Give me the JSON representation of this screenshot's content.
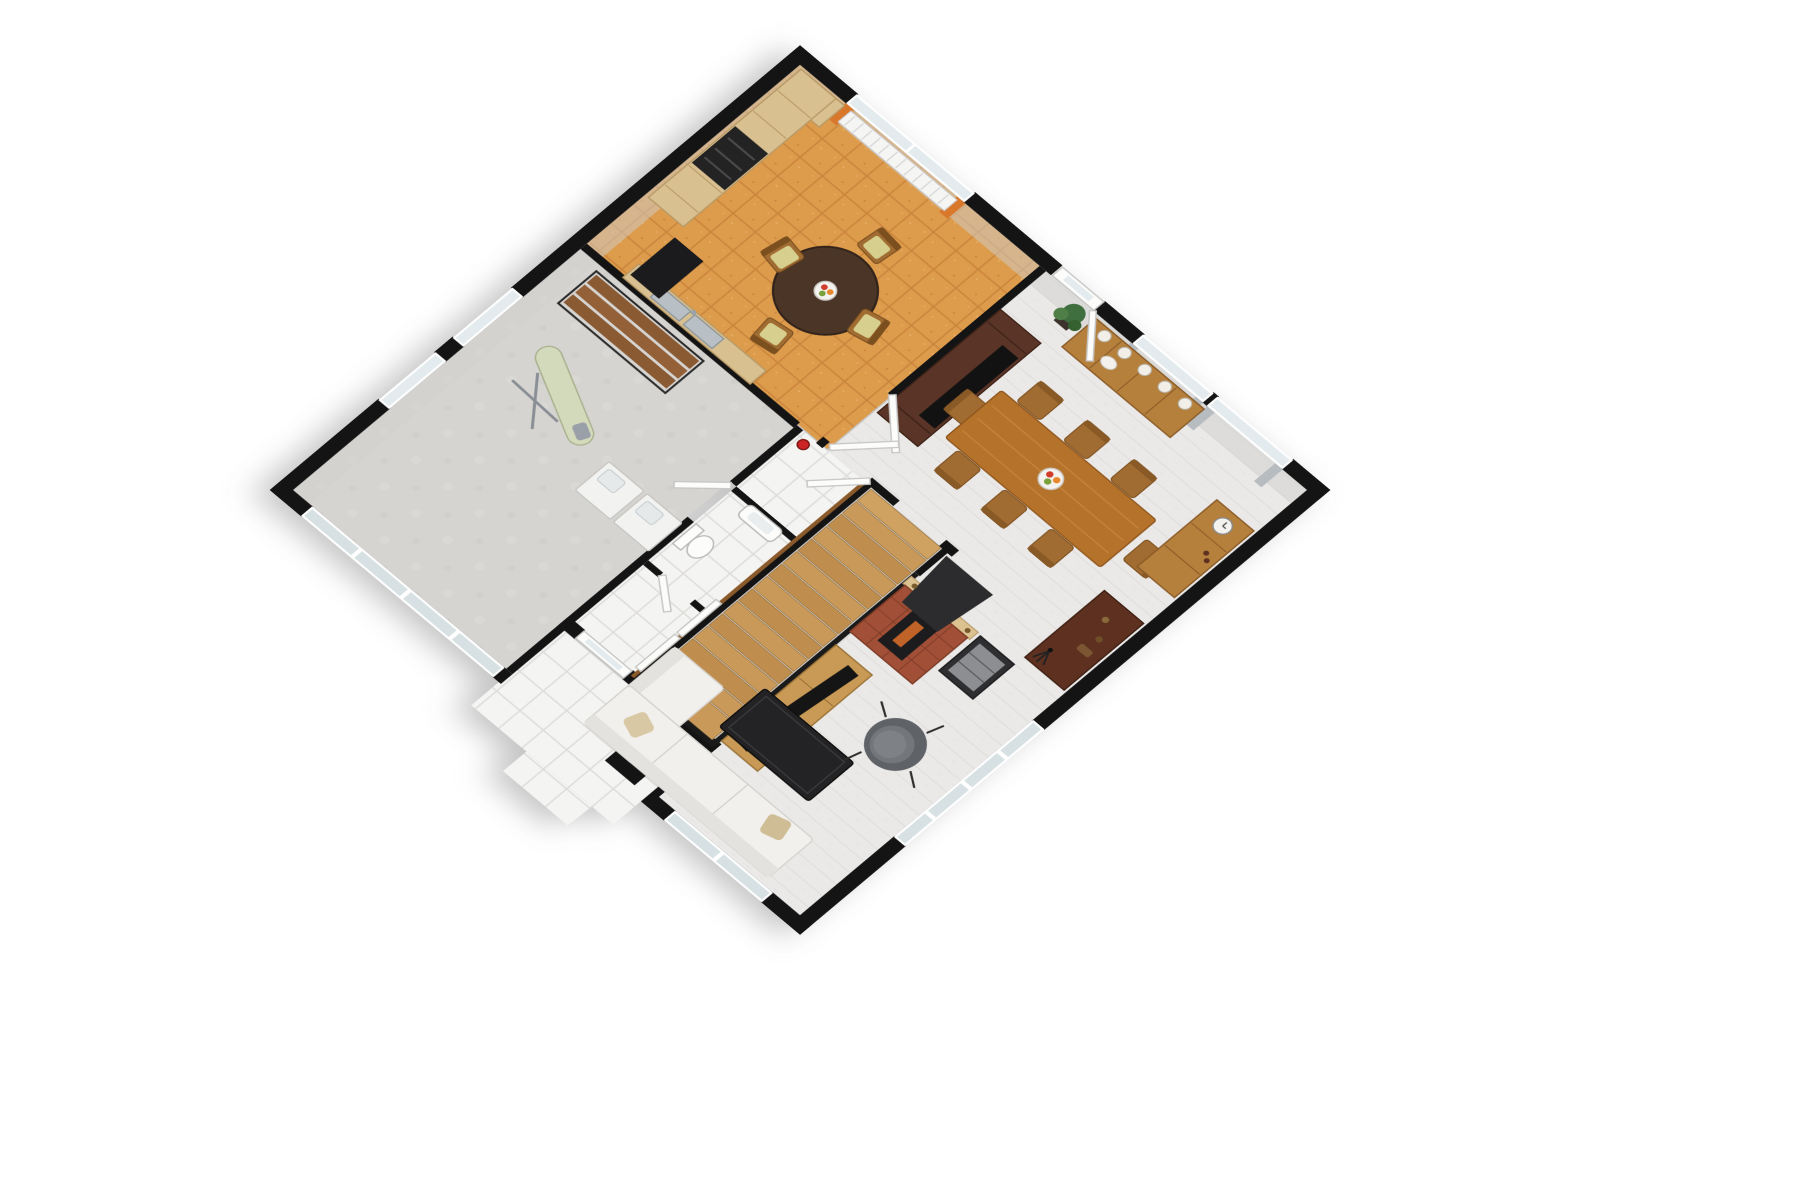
{
  "scene": {
    "type": "3d-floorplan-cutaway-render",
    "floor_label": "ground floor",
    "background": "#ffffff",
    "projection": {
      "plan_rotation_deg": 45,
      "tilt_deg": 33
    }
  },
  "palette": {
    "wall": "#141414",
    "wallFace": "#cfcfce",
    "kitchenTile": "#dd9b4c",
    "kitchenGrout": "#c9833b",
    "livingFloor": "#eae9e7",
    "livingLine": "#dfdedb",
    "utilityFloor": "#d6d4d1",
    "tileWhite": "#f4f4f2",
    "tileGrout": "#dcdbd8",
    "stairBase": "#d9d8d6",
    "tread": "#c9995a",
    "treadAlt": "#bf8e4e",
    "treadEdge": "#96713d",
    "handrail": "#8a5a2b",
    "railBlack": "#1a1a1a",
    "woodLight": "#d9c091",
    "woodLightEdge": "#b89a66",
    "woodMid": "#b5722a",
    "woodMidEdge": "#8f561c",
    "woodCab": "#b5803c",
    "woodCabEdge": "#8a5a26",
    "woodDark": "#5a3426",
    "woodDarkEdge": "#3f2318",
    "woodDesk": "#5d3020",
    "woodShelf": "#8a5a33",
    "lowboard": "#c89a55",
    "brick": "#a14f36",
    "mantel": "#dcc191",
    "hood": "#2c2c2e",
    "hifiBody": "#2f2f31",
    "hifiFront": "#8c8e92",
    "tvBlack": "#151515",
    "applianceBlack": "#232323",
    "speakerBlack": "#1b1b1d",
    "tableBlack": "#232325",
    "chairGray": "#5f6267",
    "chairGrayIn": "#74777a",
    "sofaWhite": "#f1f0ed",
    "sofaShade": "#e4e2de",
    "sofaLine": "#d5d3cf",
    "pillowBeige": "#d9c8a4",
    "chairWood": "#a06c32",
    "chairWoodEdge": "#7c4f1f",
    "chairSeat": "#d6cf8e",
    "espresso": "#4a3526",
    "steel": "#b9c0c5",
    "steelEdge": "#8f979c",
    "glass": "#e3ebee",
    "glassDark": "#d7e1e4",
    "frameWhite": "#fbfbfb",
    "doorWhite": "#fcfcfb",
    "doorEdge": "#c6c6c4",
    "curtainOrange": "#d9772b",
    "curtainGray": "#b6bcc0",
    "plantGreen": "#3f6f3f",
    "plantGreenLt": "#4f7f47",
    "potDark": "#3c342c",
    "extinguisherRed": "#cc2424",
    "applianceWhite": "#f2f2f0",
    "boardGreen": "#d3d9bb",
    "boardEdge": "#aab28f",
    "ironGray": "#9aa0a8",
    "radiatorWhite": "#f5f5f4",
    "plateWhite": "#f2efe9",
    "fruitRed": "#d23c2a",
    "fruitOrange": "#e8872c",
    "fruitGreen": "#7aa03c",
    "bowlWhite": "#f4f2ee"
  },
  "rooms": [
    {
      "id": "kitchen-dining",
      "label": "Kitchen / breakfast",
      "floor": "orange speckled tile"
    },
    {
      "id": "living-room",
      "label": "Living / dining room",
      "floor": "light plank tile"
    },
    {
      "id": "utility-room",
      "label": "Utility / laundry room",
      "floor": "gray concrete"
    },
    {
      "id": "hallway",
      "label": "Hallway / entry",
      "floor": "white tile"
    },
    {
      "id": "wc",
      "label": "WC",
      "floor": "white tile"
    },
    {
      "id": "staircase",
      "label": "Staircase",
      "floor": "wood treads"
    },
    {
      "id": "porch",
      "label": "Entry porch / terrace",
      "floor": "white tile grid"
    }
  ],
  "furniture": [
    {
      "id": "kitchen-cabinets",
      "room": "kitchen-dining",
      "label": "Light wood cabinet run with built-in oven and microwave"
    },
    {
      "id": "kitchen-counter-sink",
      "room": "kitchen-dining",
      "label": "Counter with double stainless sink"
    },
    {
      "id": "radiator",
      "room": "kitchen-dining",
      "label": "Radiator under window"
    },
    {
      "id": "kitchen-round-table",
      "room": "kitchen-dining",
      "label": "Round espresso table with 4 chairs and fruit bowl"
    },
    {
      "id": "tall-speaker",
      "room": "kitchen-dining",
      "label": "Black speaker cabinet"
    },
    {
      "id": "fire-extinguisher",
      "room": "hallway",
      "label": "Red fire extinguisher"
    },
    {
      "id": "open-shelf-unit",
      "room": "utility-room",
      "label": "Metal frame wood shelf unit"
    },
    {
      "id": "ironing-board",
      "room": "utility-room",
      "label": "Ironing board with iron"
    },
    {
      "id": "laundry-units",
      "room": "utility-room",
      "label": "Two white laundry units"
    },
    {
      "id": "wc-sink",
      "room": "wc",
      "label": "Wall hung sink"
    },
    {
      "id": "toilet",
      "room": "wc",
      "label": "Toilet"
    },
    {
      "id": "staircase-wood",
      "room": "staircase",
      "label": "Wood staircase with black railing"
    },
    {
      "id": "tv-hutch",
      "room": "living-room",
      "label": "Dark walnut media hutch"
    },
    {
      "id": "sideboard",
      "room": "living-room",
      "label": "Sideboard with decorative plates and teapot"
    },
    {
      "id": "potted-plant",
      "room": "living-room",
      "label": "Potted plant"
    },
    {
      "id": "dining-table",
      "room": "living-room",
      "label": "Dining table with 8 chairs and fruit bowl"
    },
    {
      "id": "display-cabinet",
      "room": "living-room",
      "label": "Cabinet with clock and bottles"
    },
    {
      "id": "writing-desk",
      "room": "living-room",
      "label": "Dark wood desk with figurines and camera tripod"
    },
    {
      "id": "fireplace",
      "room": "living-room",
      "label": "Brick fireplace with black chimney hood and candlesticks"
    },
    {
      "id": "hifi-cabinet",
      "room": "living-room",
      "label": "Black hi-fi cabinet"
    },
    {
      "id": "tv-lowboard",
      "room": "living-room",
      "label": "Oak lowboard with flat TV"
    },
    {
      "id": "coffee-table",
      "room": "living-room",
      "label": "Black coffee table"
    },
    {
      "id": "armchair",
      "room": "living-room",
      "label": "Gray tub armchair"
    },
    {
      "id": "corner-sofa",
      "room": "living-room",
      "label": "White corner sofa with beige cushions"
    },
    {
      "id": "glass-balustrade",
      "room": "living-room",
      "label": "Glass partition panels"
    },
    {
      "id": "sliding-glass-doors",
      "room": "utility-room",
      "label": "Glazed sliding wall"
    },
    {
      "id": "entry-door",
      "room": "porch",
      "label": "Entry door with glass pane"
    },
    {
      "id": "porch-column",
      "room": "porch",
      "label": "Black porch column base"
    }
  ]
}
